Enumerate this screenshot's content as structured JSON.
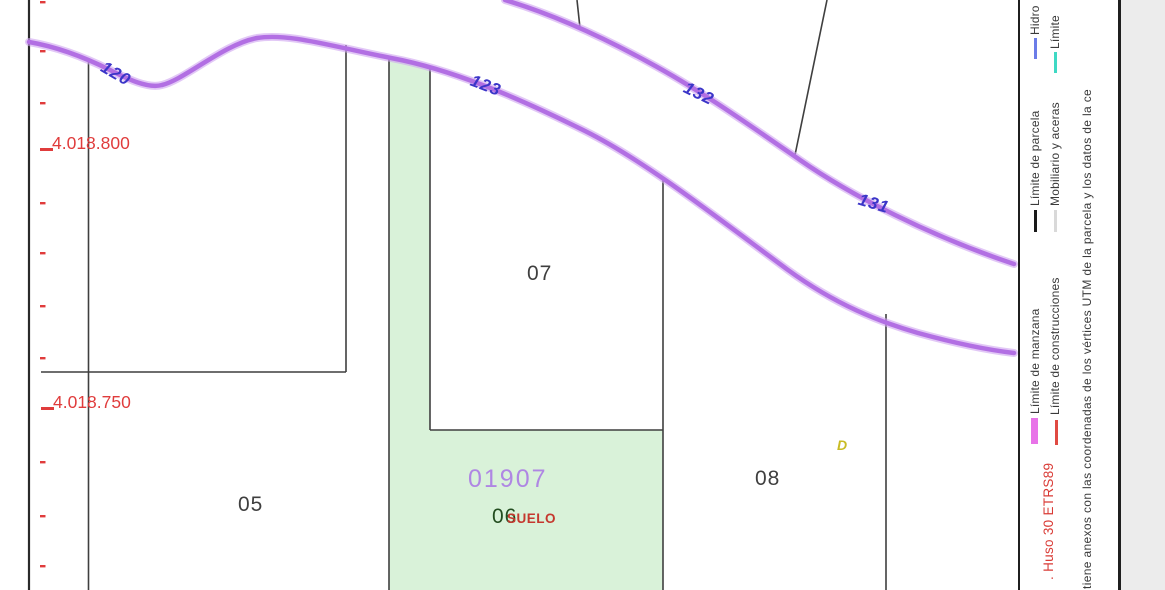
{
  "map": {
    "road_labels": [
      {
        "text": "120"
      },
      {
        "text": "123"
      },
      {
        "text": "132"
      },
      {
        "text": "131"
      }
    ],
    "grid_labels": [
      {
        "text": "4.018.800"
      },
      {
        "text": "4.018.750"
      }
    ],
    "parcel_labels": [
      {
        "text": "05"
      },
      {
        "text": "07"
      },
      {
        "text": "08"
      }
    ],
    "highlighted_parcel": {
      "code": "01907",
      "number": "06",
      "land_use": "SUELO",
      "fill_color": "#d9f2d9",
      "code_color": "#af87e3"
    },
    "annex_label": "D",
    "colors": {
      "manzana_line": "#b678e6",
      "parcel_line": "#3f3f3f",
      "road_label": "#3b35c8",
      "grid_label": "#e03c3c"
    }
  },
  "legend": {
    "column1": [
      {
        "label": "Hidro",
        "color": "#6b7ce8"
      },
      {
        "label": "Límite de parcela",
        "color": "#1a1a1a"
      },
      {
        "label": "Límite de manzana",
        "color": "#e873e8"
      }
    ],
    "column2": [
      {
        "label": "Límite",
        "color": "#3fd9c4"
      },
      {
        "label": "Mobiliario y aceras",
        "color": "#d9d9d9"
      },
      {
        "label": "Límite de construcciones",
        "color": "#e04a42"
      }
    ],
    "projection_note": ". Huso 30 ETRS89",
    "disclaimer": "ntiene anexos con las coordenadas de los vértices UTM de la parcela y los datos de la ce"
  }
}
